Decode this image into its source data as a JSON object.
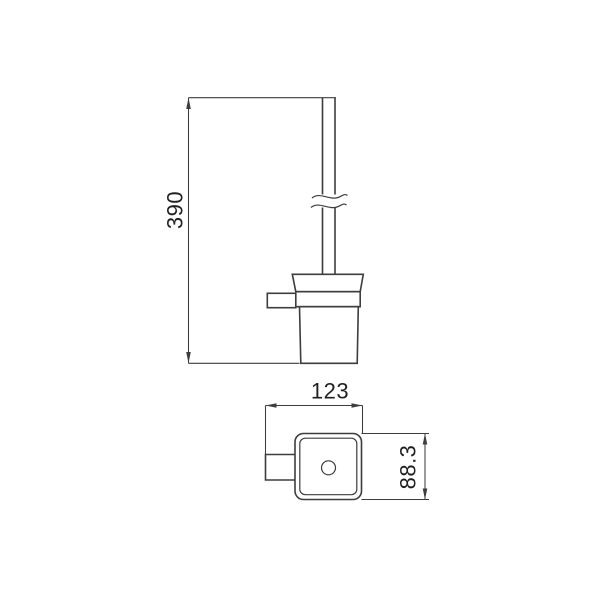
{
  "drawing": {
    "type": "technical-dimension-drawing",
    "subject": "wall-mounted toilet brush holder",
    "background_color": "#ffffff",
    "line_color": "#3d3d3d",
    "text_color": "#1f1f1f",
    "views": [
      {
        "id": "side-view",
        "description": "side elevation: brush handle with break symbol, tapered rim, band, wall bracket and cup"
      },
      {
        "id": "top-view",
        "description": "plan view: rounded square holder with center hole and wall mounting bracket"
      }
    ]
  },
  "dimensions": {
    "height": {
      "label": "390",
      "view": "side-view",
      "orientation": "vertical"
    },
    "width": {
      "label": "123",
      "view": "top-view",
      "orientation": "horizontal"
    },
    "depth": {
      "label": "88.3",
      "view": "top-view",
      "orientation": "vertical"
    }
  }
}
